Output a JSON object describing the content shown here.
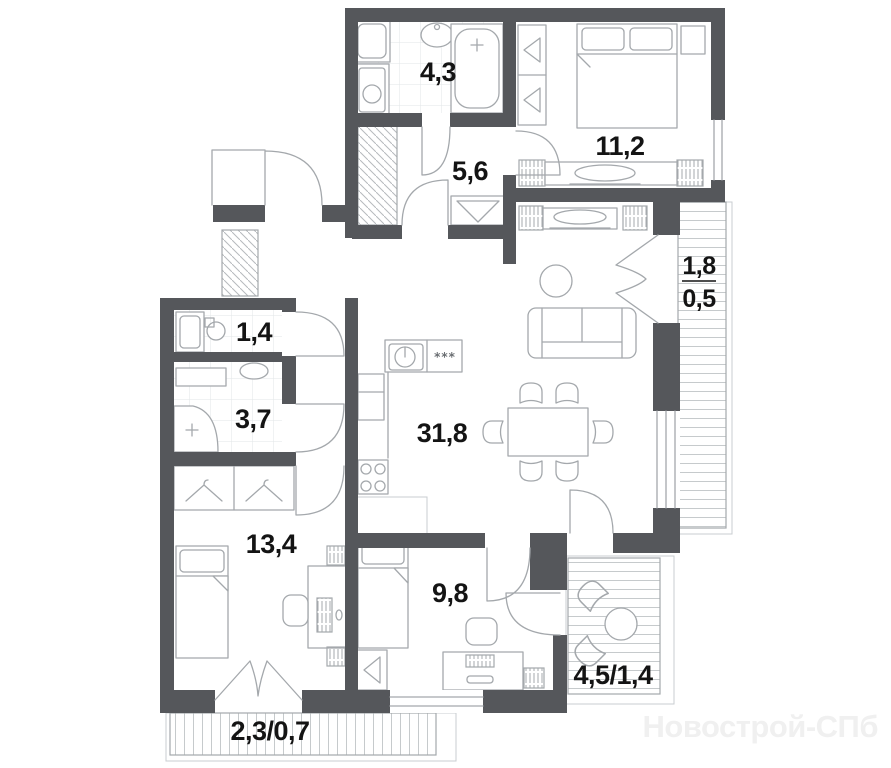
{
  "watermark": "Новострой-СПб",
  "rooms": {
    "bathroom": {
      "area": "4,3"
    },
    "hallway": {
      "area": "5,6"
    },
    "bedroom_master": {
      "area": "11,2"
    },
    "loggia_right": {
      "area_full": "1,8",
      "area_coef": "0,5"
    },
    "laundry": {
      "area": "1,4"
    },
    "shower_room": {
      "area": "3,7"
    },
    "living_kitchen": {
      "area": "31,8",
      "hob_marks": "***"
    },
    "bedroom_left": {
      "area": "13,4"
    },
    "bedroom_right": {
      "area": "9,8"
    },
    "loggia_bottom_right": {
      "area": "4,5/1,4"
    },
    "balcony_bottom_left": {
      "area": "2,3/0,7"
    }
  },
  "colors": {
    "wall": "#55575B",
    "furniture_line": "#a4a8ac",
    "hatch_line": "#c6cacc",
    "tile_line": "#e2e5e7",
    "label": "#141414",
    "watermark": "#f0f0f0"
  }
}
